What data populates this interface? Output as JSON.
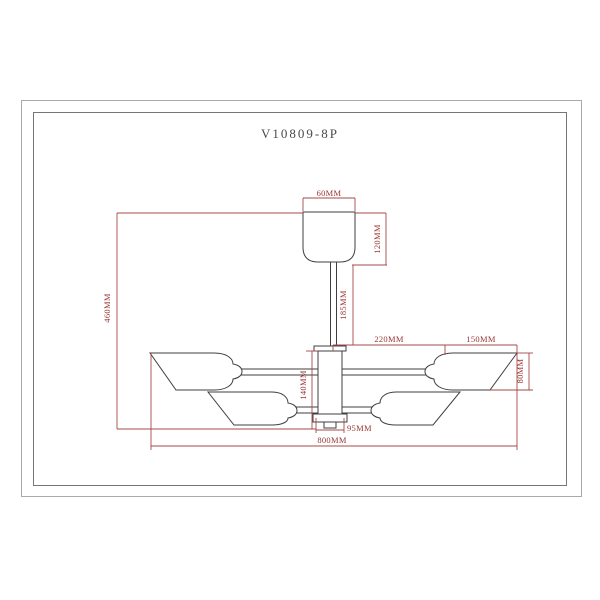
{
  "drawing": {
    "model": "V10809-8P",
    "type": "ceiling-lamp-dimension-drawing",
    "units": "MM",
    "dimensions": {
      "canopy_diameter": "60MM",
      "canopy_height": "120MM",
      "stem_length": "185MM",
      "overall_height": "460MM",
      "arm_reach": "220MM",
      "shade_length": "150MM",
      "shade_height": "80MM",
      "hub_height": "140MM",
      "hub_diameter": "95MM",
      "overall_diameter": "800MM"
    },
    "colors": {
      "dimension_lines": "#a64848",
      "dimension_text": "#9a3535",
      "drawing_lines": "#3f3f3f",
      "border_outer": "#a9a9a9",
      "border_inner": "#767676",
      "background": "#ffffff",
      "title_text": "#4a4a4a"
    }
  }
}
